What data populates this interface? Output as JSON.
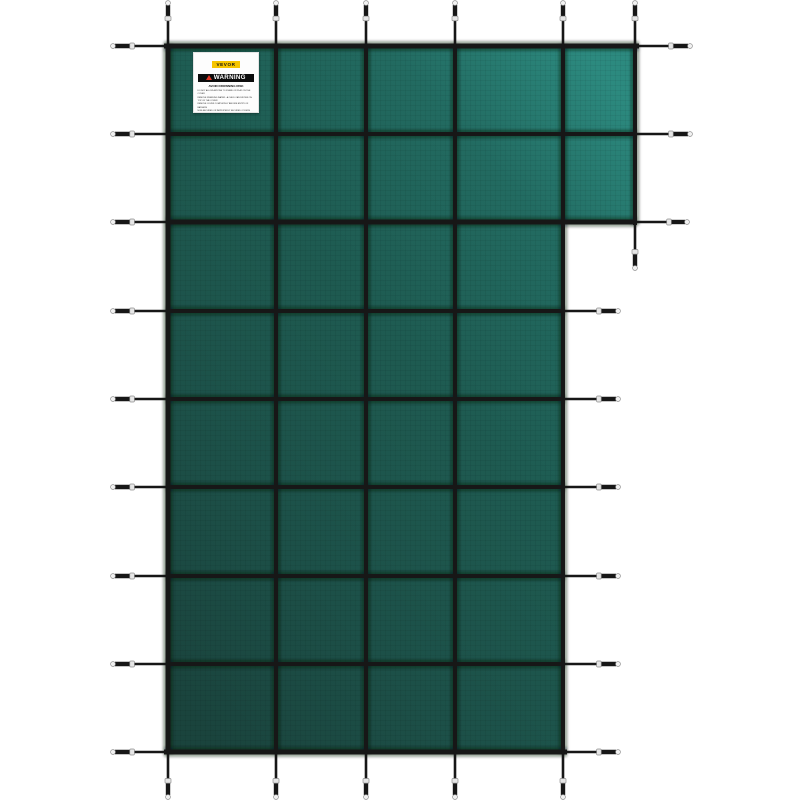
{
  "image": {
    "background": "#ffffff",
    "subject": "green mesh safety pool cover with strap grid and spring anchors"
  },
  "label": {
    "brand": "VEVOR",
    "brand_bg": "#f6c500",
    "warning_title": "WARNING",
    "banner_bg": "#0c0c0c",
    "triangle_color": "#e03524",
    "heading": "AVOID DROWNING RISK",
    "lines": [
      "DO NOT ALLOW ANYONE TO STAND OR PLAY ON THE COVER",
      "REMOVE STANDING WATER - A CHILD CAN DROWN ON TOP OF THE COVER",
      "REMOVE COVER COMPLETELY BEFORE ENTRY OF BATHERS",
      "NON-SECURED OR IMPROPERLY SECURED COVERS ARE A HAZARD",
      "KEEP CHILDREN AWAY WHEN INSTALLING OR REMOVING THE COVER",
      "FAILURE TO FOLLOW ALL WARNINGS MAY RESULT IN INJURY OR DROWNING",
      "READ ALL INSTRUCTIONS BEFORE USE"
    ]
  },
  "scene": {
    "canvas": {
      "width": 800,
      "height": 800
    },
    "cover": {
      "polygon": [
        [
          166,
          46
        ],
        [
          637,
          46
        ],
        [
          637,
          223
        ],
        [
          565,
          223
        ],
        [
          565,
          752
        ],
        [
          166,
          752
        ]
      ],
      "gradient": {
        "x1": "88%",
        "y1": "0%",
        "x2": "12%",
        "y2": "100%",
        "stops": [
          {
            "offset": "0%",
            "color": "#2c8a7f"
          },
          {
            "offset": "20%",
            "color": "#226b61"
          },
          {
            "offset": "45%",
            "color": "#1e5b51"
          },
          {
            "offset": "75%",
            "color": "#1c5048"
          },
          {
            "offset": "100%",
            "color": "#1a443d"
          }
        ]
      },
      "texture_color": "rgba(0,0,0,0.05)",
      "texture_step": 5
    },
    "strap_color": "#171717",
    "strap_shadow": "rgba(8,20,17,0.38)",
    "spring": {
      "metal": "#e6e6e6",
      "metal_border": "#8f8f8f",
      "tip_fill": "#f2f2f2",
      "buckle_long": 6,
      "buckle_short": 4.6,
      "tip_r": 2.4,
      "outer_w": 4.4,
      "line_w": 2.6,
      "buckle_frac": 0.64
    },
    "straps": [
      {
        "x1": 164,
        "y1": 46,
        "x2": 639,
        "y2": 46,
        "w": 5
      },
      {
        "x1": 166,
        "y1": 134,
        "x2": 637,
        "y2": 134,
        "w": 4
      },
      {
        "x1": 166,
        "y1": 222,
        "x2": 637,
        "y2": 222,
        "w": 5
      },
      {
        "x1": 166,
        "y1": 311,
        "x2": 565,
        "y2": 311,
        "w": 4
      },
      {
        "x1": 166,
        "y1": 399,
        "x2": 565,
        "y2": 399,
        "w": 4
      },
      {
        "x1": 166,
        "y1": 487,
        "x2": 565,
        "y2": 487,
        "w": 4
      },
      {
        "x1": 166,
        "y1": 576,
        "x2": 565,
        "y2": 576,
        "w": 4
      },
      {
        "x1": 166,
        "y1": 664,
        "x2": 565,
        "y2": 664,
        "w": 4
      },
      {
        "x1": 164,
        "y1": 752,
        "x2": 567,
        "y2": 752,
        "w": 5
      },
      {
        "x1": 168,
        "y1": 44,
        "x2": 168,
        "y2": 754,
        "w": 5
      },
      {
        "x1": 276,
        "y1": 44,
        "x2": 276,
        "y2": 754,
        "w": 4
      },
      {
        "x1": 366,
        "y1": 44,
        "x2": 366,
        "y2": 754,
        "w": 4
      },
      {
        "x1": 455,
        "y1": 44,
        "x2": 455,
        "y2": 754,
        "w": 4
      },
      {
        "x1": 563,
        "y1": 44,
        "x2": 563,
        "y2": 754,
        "w": 4
      },
      {
        "x1": 635,
        "y1": 44,
        "x2": 635,
        "y2": 225,
        "w": 4
      }
    ],
    "anchors": [
      {
        "x": 168,
        "y": 46,
        "dir": "up",
        "len": 43
      },
      {
        "x": 276,
        "y": 46,
        "dir": "up",
        "len": 43
      },
      {
        "x": 366,
        "y": 46,
        "dir": "up",
        "len": 43
      },
      {
        "x": 455,
        "y": 46,
        "dir": "up",
        "len": 43
      },
      {
        "x": 563,
        "y": 46,
        "dir": "up",
        "len": 43
      },
      {
        "x": 635,
        "y": 46,
        "dir": "up",
        "len": 43
      },
      {
        "x": 168,
        "y": 752,
        "dir": "down",
        "len": 45
      },
      {
        "x": 276,
        "y": 752,
        "dir": "down",
        "len": 45
      },
      {
        "x": 366,
        "y": 752,
        "dir": "down",
        "len": 45
      },
      {
        "x": 455,
        "y": 752,
        "dir": "down",
        "len": 45
      },
      {
        "x": 563,
        "y": 752,
        "dir": "down",
        "len": 45
      },
      {
        "x": 635,
        "y": 223,
        "dir": "down",
        "len": 45
      },
      {
        "x": 166,
        "y": 46,
        "dir": "left",
        "len": 53
      },
      {
        "x": 166,
        "y": 134,
        "dir": "left",
        "len": 53
      },
      {
        "x": 166,
        "y": 222,
        "dir": "left",
        "len": 53
      },
      {
        "x": 166,
        "y": 311,
        "dir": "left",
        "len": 53
      },
      {
        "x": 166,
        "y": 399,
        "dir": "left",
        "len": 53
      },
      {
        "x": 166,
        "y": 487,
        "dir": "left",
        "len": 53
      },
      {
        "x": 166,
        "y": 576,
        "dir": "left",
        "len": 53
      },
      {
        "x": 166,
        "y": 664,
        "dir": "left",
        "len": 53
      },
      {
        "x": 166,
        "y": 752,
        "dir": "left",
        "len": 53
      },
      {
        "x": 637,
        "y": 46,
        "dir": "right",
        "len": 53
      },
      {
        "x": 637,
        "y": 134,
        "dir": "right",
        "len": 53
      },
      {
        "x": 637,
        "y": 222,
        "dir": "right",
        "len": 50
      },
      {
        "x": 565,
        "y": 311,
        "dir": "right",
        "len": 53
      },
      {
        "x": 565,
        "y": 399,
        "dir": "right",
        "len": 53
      },
      {
        "x": 565,
        "y": 487,
        "dir": "right",
        "len": 53
      },
      {
        "x": 565,
        "y": 576,
        "dir": "right",
        "len": 53
      },
      {
        "x": 565,
        "y": 664,
        "dir": "right",
        "len": 53
      },
      {
        "x": 565,
        "y": 752,
        "dir": "right",
        "len": 53
      }
    ]
  }
}
